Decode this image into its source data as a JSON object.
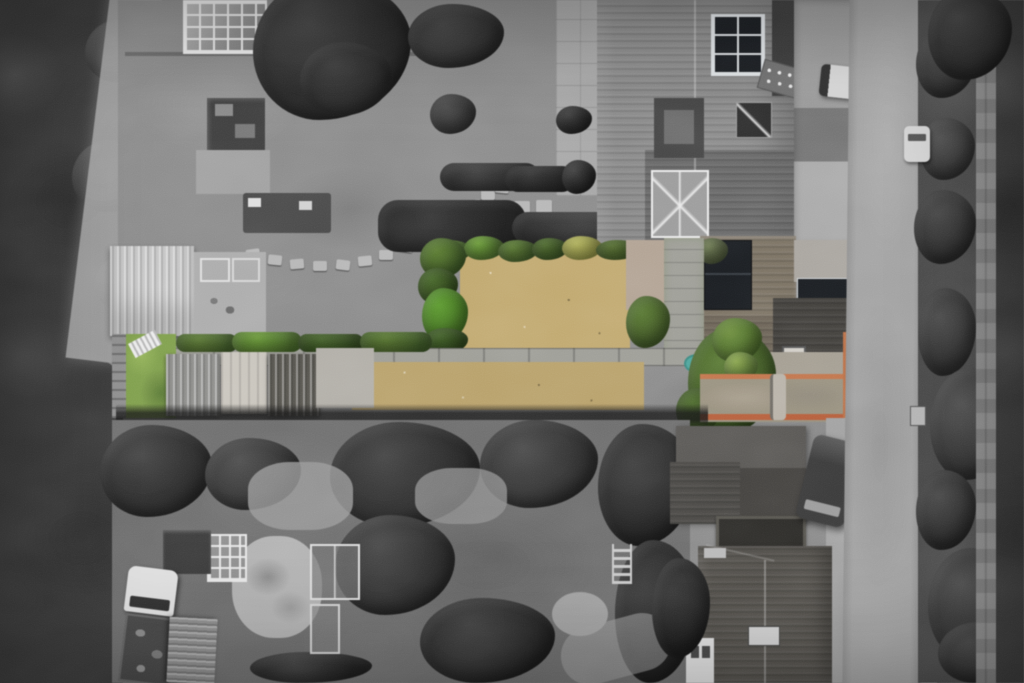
{
  "scene": {
    "type": "aerial-drone-photograph",
    "treatment": "selective-colour",
    "description": "Top-down drone photograph of a terraced residential plot. The subject property's long narrow rear garden, sheds, gravel patio, solar-panelled roofs and terracotta-edged driveway are rendered in colour; all neighbouring gardens, houses, the vertical road on the right and the woodland on the left are desaturated greyscale.",
    "no_visible_text": true,
    "regions": [
      {
        "id": "woodland-left",
        "label": "Dark woodland strip along left edge",
        "color": "woodland_dark"
      },
      {
        "id": "dirt-track-left",
        "label": "Light dirt track running down from top left",
        "color": "track_gray"
      },
      {
        "id": "neighbour-garden-top-left",
        "label": "Greyscale neighbour garden with greenhouse, sheds and stepping-stone path",
        "color": "lawn_gray"
      },
      {
        "id": "light-shed-roof",
        "label": "Large corrugated light-grey shed roof",
        "color": "shed_light"
      },
      {
        "id": "main-house-roof",
        "label": "Tall grey tiled terrace house roof with solar array",
        "color": "roof_gray"
      },
      {
        "id": "solar-panels",
        "label": "Black rooftop solar panel arrays",
        "color": "solar_black"
      },
      {
        "id": "conservatory",
        "label": "White-framed glass conservatory",
        "color": "conservatory_white"
      },
      {
        "id": "subject-lawn-upper",
        "label": "Subject property's dry tan lawn (in colour)",
        "color": "lawn_tan"
      },
      {
        "id": "subject-lawn-lower",
        "label": "Second strip of dry tan lawn below the path",
        "color": "lawn_tan"
      },
      {
        "id": "subject-hedges",
        "label": "Green hedges and bushes bordering the lawn",
        "color": "hedge_green"
      },
      {
        "id": "yellow-bush",
        "label": "Yellow-green bush in top hedge row",
        "color": "bush_yellow"
      },
      {
        "id": "gravel-patio",
        "label": "Pinkish gravel patio beside the house",
        "color": "gravel_pink"
      },
      {
        "id": "concrete-path",
        "label": "Long concrete path crossing the garden",
        "color": "path_gray"
      },
      {
        "id": "garden-sheds",
        "label": "Row of three shed roofs on the subject plot",
        "color": "shed_dark"
      },
      {
        "id": "green-grass-left",
        "label": "Small green grass patch at far left of plot",
        "color": "grass_green"
      },
      {
        "id": "garden-tree",
        "label": "Green tree over the path near the driveway",
        "color": "tree_green"
      },
      {
        "id": "paddling-pool",
        "label": "Small teal pool on the path",
        "color": "pool_teal"
      },
      {
        "id": "driveway",
        "label": "Driveway with terracotta brick edging",
        "color": "terracotta"
      },
      {
        "id": "road-right",
        "label": "Vertical road with grass verge and hedgerow",
        "color": "road_gray"
      },
      {
        "id": "parked-cars",
        "label": "Parked vehicles: white pickup, dark van, black car, white van",
        "color": "car_black"
      },
      {
        "id": "bottom-garden",
        "label": "Greyscale allotment-style garden with gravel circle, greenhouse and cold frames",
        "color": "verge_dark"
      },
      {
        "id": "bottom-house-roof",
        "label": "Dark hipped roof of house at bottom with chimney",
        "color": "house_b_roof"
      }
    ]
  },
  "palette": {
    "canvas_bg": "#828282",
    "woodland_dark": "#3a3a3a",
    "track_gray": "#a4a4a4",
    "lawn_gray": "#8b8b8b",
    "roof_gray": "#8a8a8a",
    "roof_dark": "#3f3f3f",
    "roof_brown": "#7b7264",
    "garage_dark": "#42403c",
    "solar_black": "#1d2024",
    "panel_frame": "#dfe3e6",
    "conservatory_white": "#e9e9e9",
    "shed_light": "#c4c4c4",
    "shed_wood": "#c7c3bb",
    "shed_dark": "#57554f",
    "concrete": "#a9a9a9",
    "path_gray": "#9c9c96",
    "road_gray": "#a1a1a1",
    "verge_dark": "#4a4a4a",
    "lawn_tan": "#bfa76f",
    "lawn_tan_dark": "#a8905c",
    "lawn_tan_light": "#cdb87e",
    "hedge_green": "#5d7c35",
    "hedge_green_dark": "#43602b",
    "hedge_green_bright": "#6fa03c",
    "bush_yellow": "#b2b35c",
    "grass_green": "#7f9e4d",
    "tree_green": "#5c7a38",
    "tree_green_light": "#8aa54e",
    "gravel_pink": "#b0a193",
    "terracotta": "#c0744c",
    "pool_teal": "#4fa39b",
    "truck_white": "#dedede",
    "van_dark": "#3b3b3b",
    "car_black": "#1f1f1f",
    "car_white": "#d2d2d2",
    "house_b_roof": "#56534e"
  }
}
